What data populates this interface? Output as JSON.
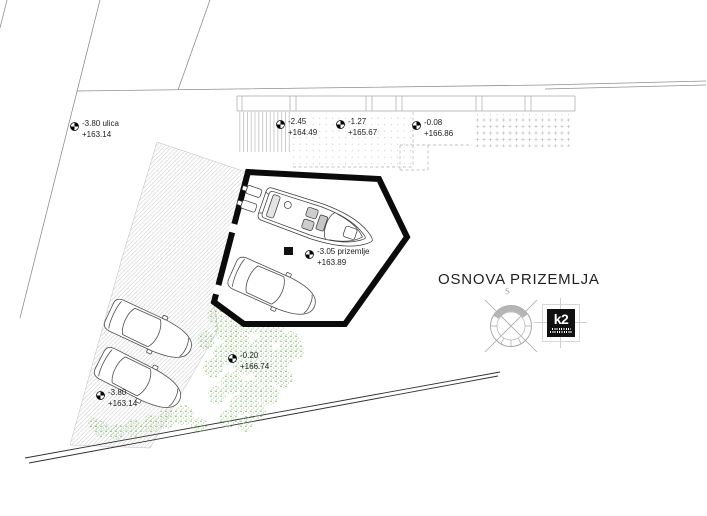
{
  "drawing": {
    "title": "OSNOVA PRIZEMLJA",
    "compass_north_label": "S",
    "logo_text": "k2"
  },
  "markers": [
    {
      "line1": "-3.80 ulica",
      "line2": "+163.14"
    },
    {
      "line1": "-2.45",
      "line2": "+164.49"
    },
    {
      "line1": "-1.27",
      "line2": "+165.67"
    },
    {
      "line1": "-0.08",
      "line2": "+166.86"
    },
    {
      "line1": "-3.05 prizemlje",
      "line2": "+163.89"
    },
    {
      "line1": "-3.80",
      "line2": "+163.14"
    },
    {
      "line1": "-0.20",
      "line2": "+166.74"
    }
  ],
  "colors": {
    "wall": "#0b0b0b",
    "tree_green": "#79b266",
    "hatch_gray": "#c6c6c6"
  }
}
